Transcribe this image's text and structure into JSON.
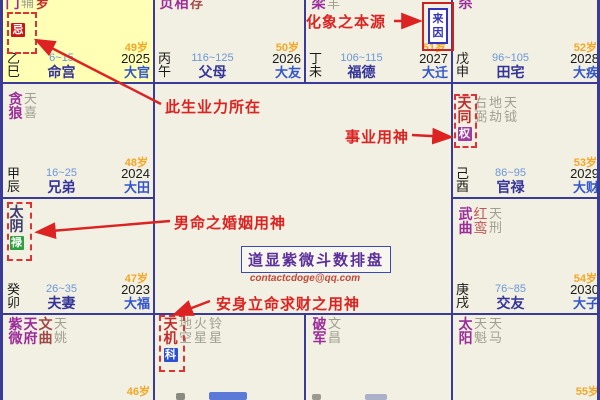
{
  "palaces": [
    {
      "stem": "乙",
      "branch": "巳",
      "range": "6~15",
      "palace": "命宫",
      "age": "49岁",
      "year": "2025",
      "da": "大官",
      "badge": "忌",
      "stars": [
        {
          "name": "门"
        },
        {
          "name": "辅"
        },
        {
          "name": "罗"
        }
      ]
    },
    {
      "stem": "丙",
      "branch": "午",
      "range": "116~125",
      "palace": "父母",
      "age": "50岁",
      "year": "2026",
      "da": "大友",
      "stars": [
        {
          "name": "贞"
        },
        {
          "name": "相"
        },
        {
          "name": "存"
        }
      ]
    },
    {
      "stem": "丁",
      "branch": "未",
      "range": "106~115",
      "palace": "福德",
      "age": "51岁",
      "year": "2027",
      "da": "大迁",
      "stars": [
        {
          "name": "梁"
        },
        {
          "name": "羊"
        }
      ]
    },
    {
      "stem": "戊",
      "branch": "申",
      "range": "96~105",
      "palace": "田宅",
      "age": "52岁",
      "year": "2028",
      "da": "大疾",
      "stars": [
        {
          "name": "杀"
        }
      ]
    },
    {
      "stem": "甲",
      "branch": "辰",
      "range": "16~25",
      "palace": "兄弟",
      "age": "48岁",
      "year": "2024",
      "da": "大田",
      "stars": [
        {
          "name": "贪狼"
        },
        {
          "name": "天喜"
        }
      ]
    },
    {
      "stem": "己",
      "branch": "酉",
      "range": "86~95",
      "palace": "官禄",
      "age": "53岁",
      "year": "2029",
      "da": "大财",
      "stars": [
        {
          "name": "天同",
          "badge": "权"
        },
        {
          "name": "右弼"
        },
        {
          "name": "地劫"
        },
        {
          "name": "天钺"
        }
      ]
    },
    {
      "stem": "癸",
      "branch": "卯",
      "range": "26~35",
      "palace": "夫妻",
      "age": "47岁",
      "year": "2023",
      "da": "大福",
      "stars": [
        {
          "name": "太阴",
          "badge": "禄"
        }
      ]
    },
    {
      "stem": "庚",
      "branch": "戌",
      "range": "76~85",
      "palace": "交友",
      "age": "54岁",
      "year": "2030",
      "da": "大子",
      "stars": [
        {
          "name": "武曲"
        },
        {
          "name": "红鸾"
        },
        {
          "name": "天刑"
        }
      ]
    },
    {
      "age": "46岁",
      "stars": [
        {
          "name": "紫微"
        },
        {
          "name": "天府"
        },
        {
          "name": "文曲"
        },
        {
          "name": "天姚"
        }
      ]
    },
    {
      "stars": [
        {
          "name": "天机",
          "badge": "科"
        },
        {
          "name": "地空"
        },
        {
          "name": "火星"
        },
        {
          "name": "铃星"
        }
      ]
    },
    {
      "stars": [
        {
          "name": "破军"
        },
        {
          "name": "文昌"
        }
      ]
    },
    {
      "age": "55岁",
      "stars": [
        {
          "name": "太阳"
        },
        {
          "name": "天魁"
        },
        {
          "name": "天马"
        }
      ]
    }
  ],
  "center": {
    "watermark": "道显紫微斗数排盘",
    "email": "contactcdoge@qq.com"
  },
  "annotations": {
    "origin_label": "化象之本源",
    "karma_label": "此生业力所在",
    "career_label": "事业用神",
    "marriage_label": "男命之婚姻用神",
    "wealth_label": "安身立命求财之用神",
    "laiyin_marker": "来因"
  },
  "colors": {
    "grid": "#3A3A99",
    "life_palace_bg": "#FFFFB5",
    "cell_bg": "#F1F0E2",
    "annotation_red": "#DD2222",
    "badge_ji": "#CC1515",
    "badge_quan": "#A03BA0",
    "badge_lu": "#2FA040",
    "badge_ke": "#2C50D0",
    "age_orange": "#F5A623",
    "palace_navy": "#333399"
  }
}
